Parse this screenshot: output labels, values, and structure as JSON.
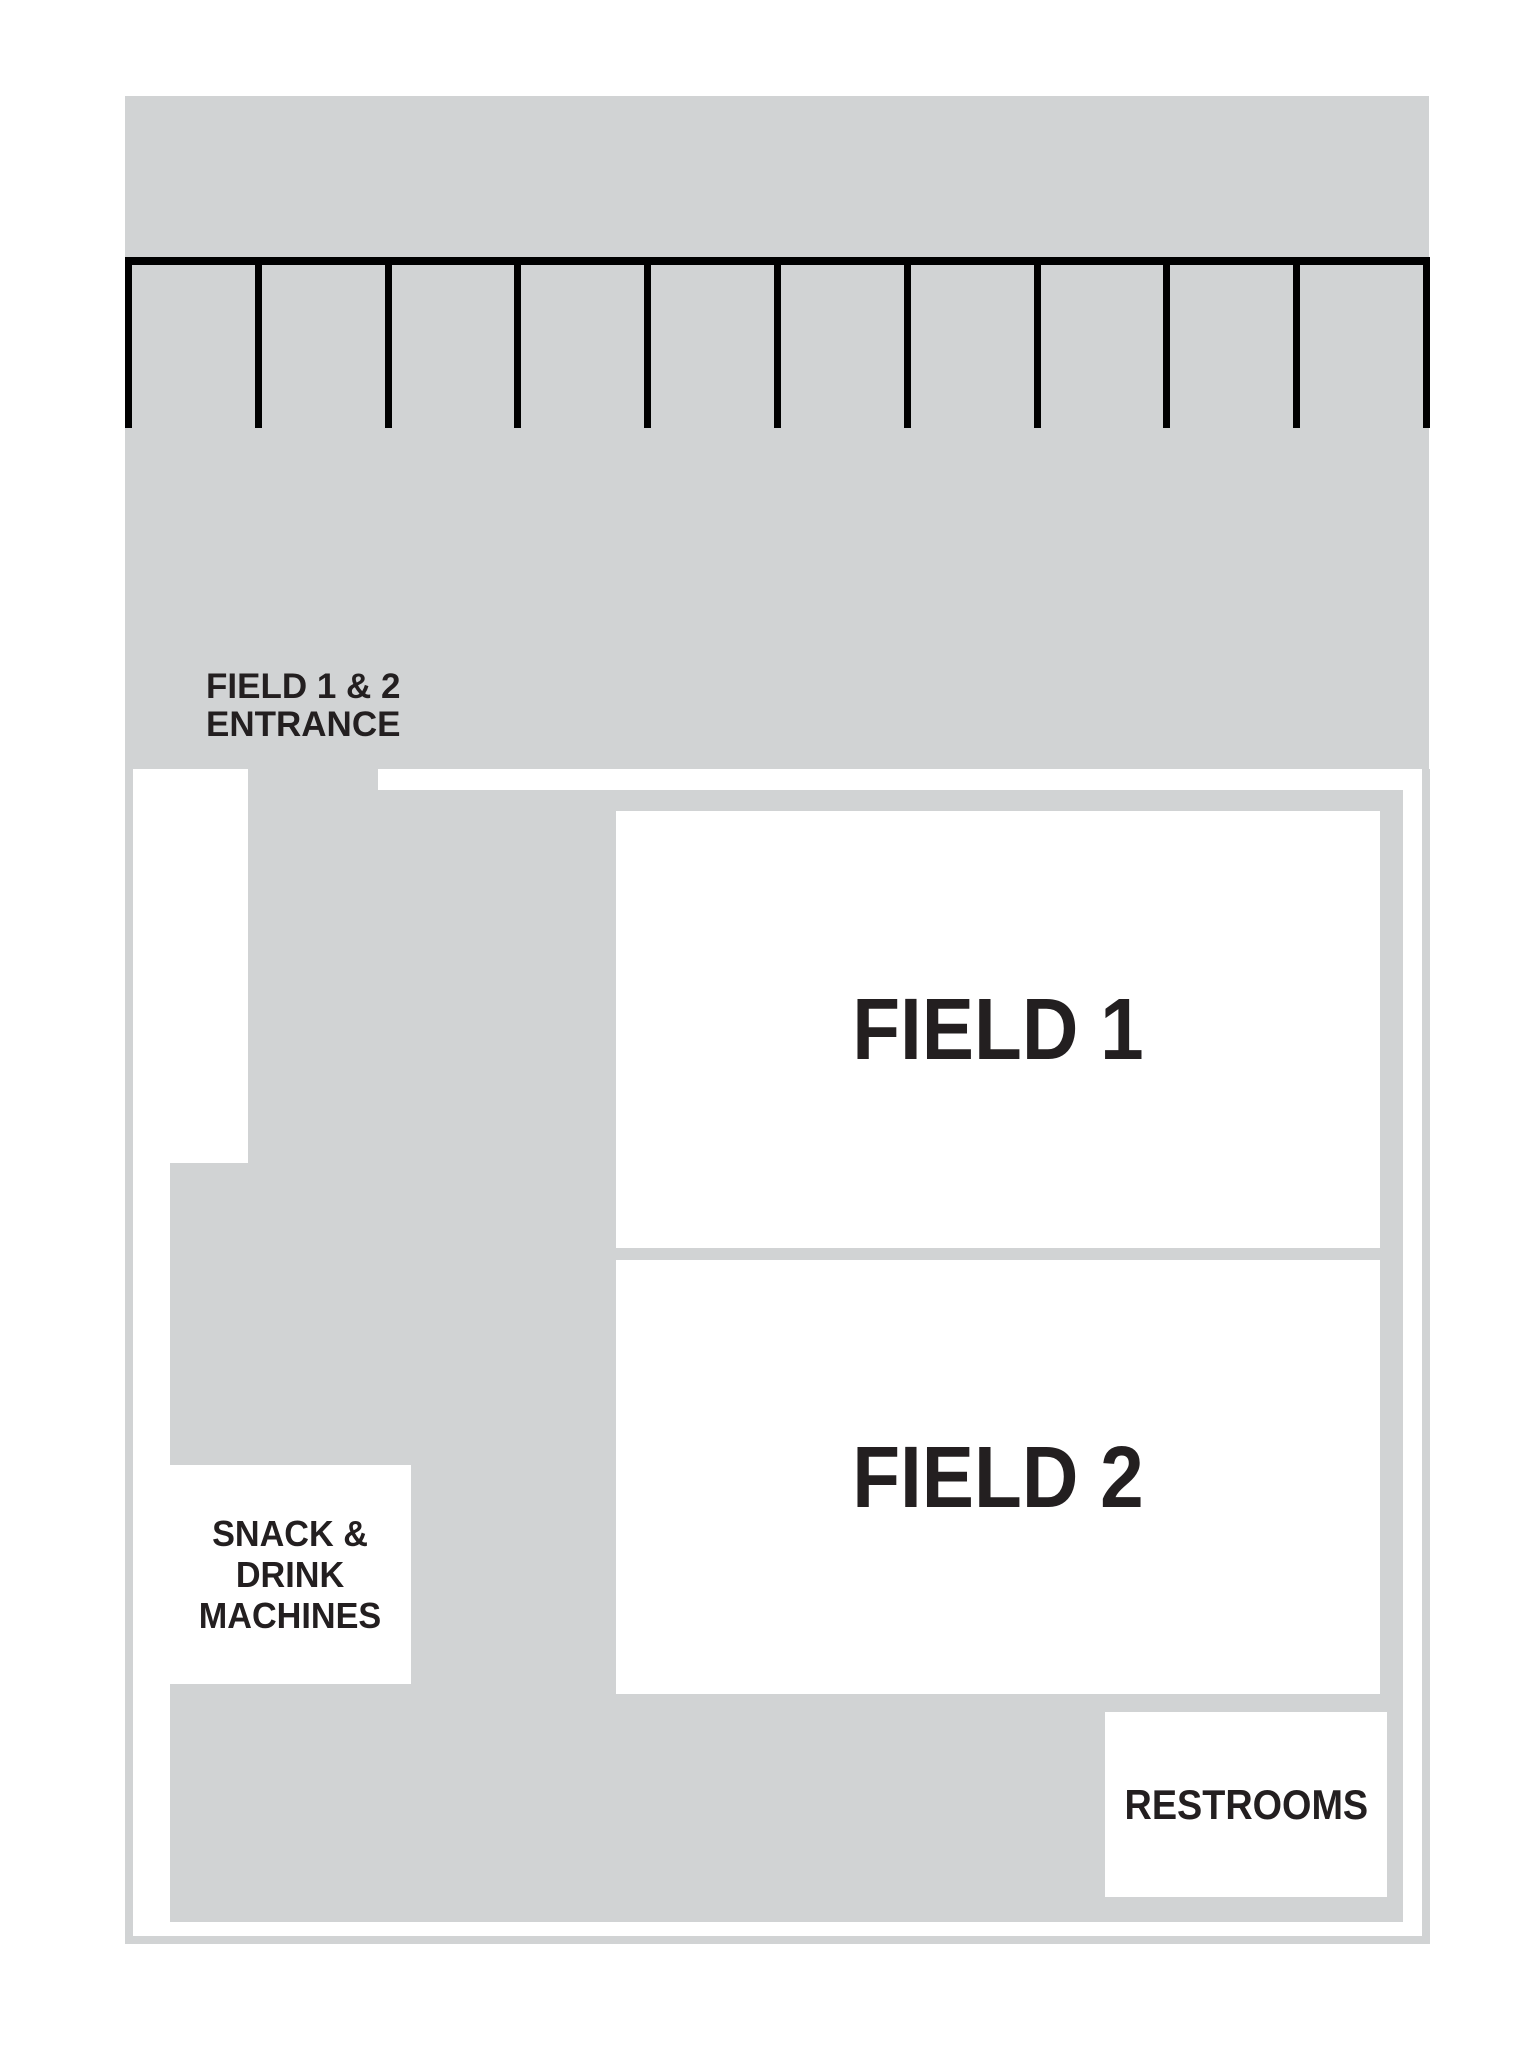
{
  "map": {
    "kind": "sports-facility-site-map",
    "colors": {
      "ground": "#d1d3d4",
      "parking_line": "#000000",
      "text": "#231f20",
      "path": "#ffffff"
    },
    "parking": {
      "stall_line_count": 11
    },
    "labels": {
      "entrance": {
        "line1": "FIELD 1 & 2",
        "line2": "ENTRANCE"
      },
      "field1": "FIELD 1",
      "field2": "FIELD 2",
      "snack": {
        "line1": "SNACK &",
        "line2": "DRINK",
        "line3": "MACHINES"
      },
      "restrooms": "RESTROOMS"
    }
  }
}
